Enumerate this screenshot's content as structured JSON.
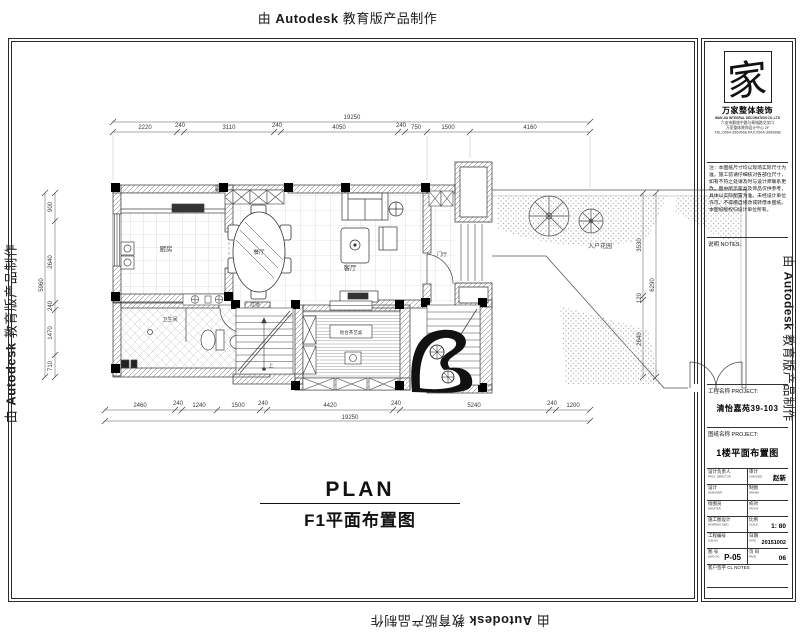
{
  "watermark": {
    "pre": "由",
    "brand": "Autodesk",
    "post": "教育版产品制作"
  },
  "plan_title": {
    "en": "PLAN",
    "zh": "F1平面布置图"
  },
  "rooms": {
    "kitchen": "厨房",
    "dining": "餐厅",
    "living": "客厅",
    "entry": "门厅",
    "bath": "卫生间",
    "corridor": "过道",
    "garden": "入户花园",
    "tea_label": "地台茶艺桌",
    "stair_up": "上"
  },
  "dims": {
    "top": [
      "2220",
      "240",
      "3110",
      "240",
      "4050",
      "240",
      "750",
      "1500",
      "4160"
    ],
    "top_total": "19250",
    "bottom": [
      "2460",
      "240",
      "1240",
      "1500",
      "240",
      "4420",
      "240",
      "5240",
      "240",
      "1200"
    ],
    "bottom_total": "19250",
    "left": [
      "900",
      "2640",
      "240",
      "1470",
      "710"
    ],
    "left_total": "5960",
    "right": [
      "3530",
      "120",
      "2640"
    ],
    "right_total": "6290"
  },
  "titleblock": {
    "logo_char": "家",
    "company": "万家整体装饰",
    "company_en": "WAN JIA INTEGRAL DECORATION CO.,LTD",
    "address_lines": [
      "六安市解放中路与皋城路交叉口",
      "万家整体装饰设计中心 2F",
      "TEL:0564-3969666  FAX:0564-3969888"
    ],
    "notes_text": "注：本图纸尺寸均以现场实际尺寸为准，施工前请仔细核对各部位尺寸，如有不符之处请及时与设计师联系更改。图中所示家具及饰品仅供参考，具体以实际配置为准。未经设计单位许可，不得擅自修改或转借本图纸。本图纸版权归设计单位所有。",
    "notes_label": "说明  NOTES:",
    "project_label": "工程名称 PROJECT:",
    "project_value": "清怡嘉苑39-103",
    "drawing_label": "图纸名称 PROJECT:",
    "drawing_value": "1楼平面布置图",
    "table": {
      "r1l": "设计负责人",
      "r1l_sub": "PROJ. DIRECTOR",
      "r1r": "审计",
      "r1r_sub": "CHECKED",
      "r1r_val": "赵新",
      "r2l": "设计",
      "r2l_sub": "DESIGNER",
      "r2r": "制图",
      "r2r_sub": "DRAWN",
      "r3l": "绘图员",
      "r3l_sub": "DRAFTER",
      "r3r": "校对",
      "r3r_sub": "PROOF",
      "r4l": "施工图设计",
      "r4l_sub": "WORKING DWG.",
      "r4r": "比例",
      "r4r_sub": "SCALE",
      "r4r_val": "1: 80",
      "r5l": "工程编号",
      "r5l_sub": "JOB NO.",
      "r5r": "日期",
      "r5r_sub": "DATE",
      "r5r_val": "20151002",
      "r6l": "图 号",
      "r6l_sub": "DWG NO.",
      "r6l_val": "P-05",
      "r6r": "页 码",
      "r6r_sub": "PAGE",
      "r6r_val": "06",
      "r7": "客户签字 CL NOTES"
    }
  }
}
